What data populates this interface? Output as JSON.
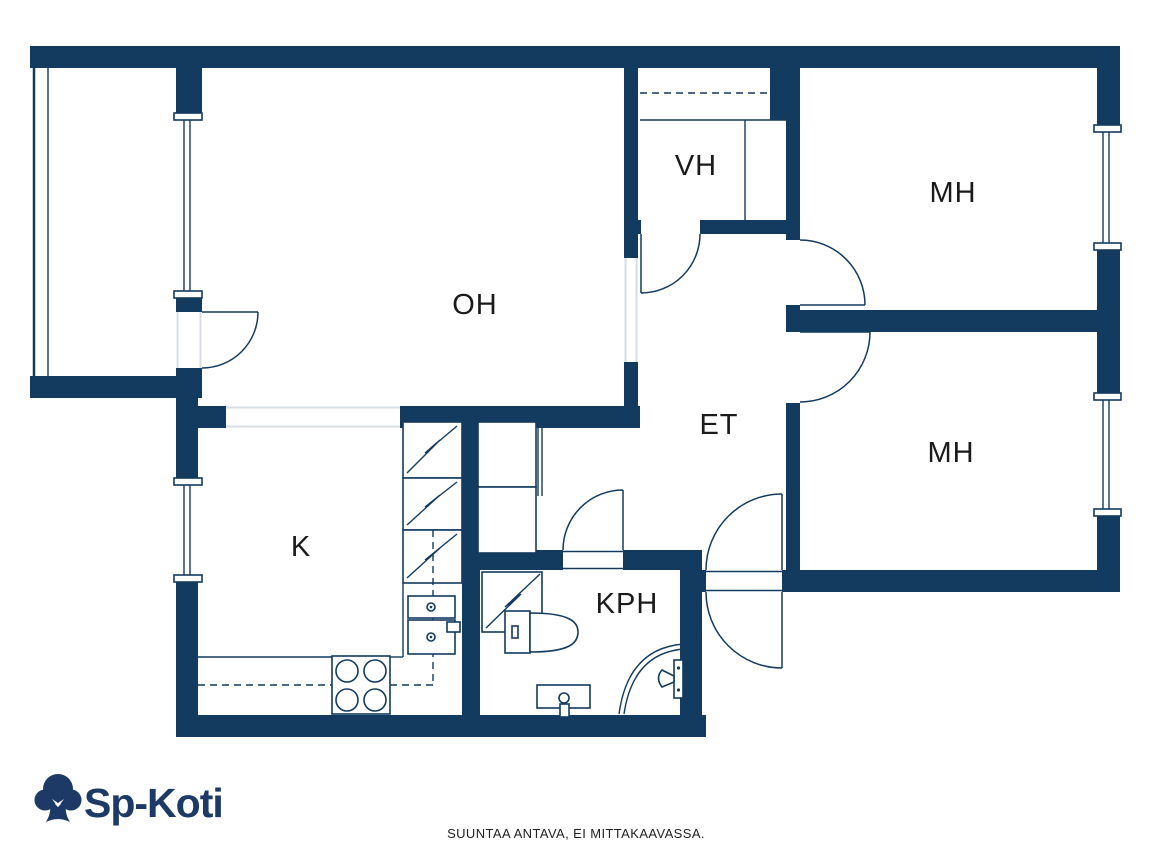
{
  "plan": {
    "rooms": [
      {
        "id": "oh",
        "label": "OH"
      },
      {
        "id": "vh",
        "label": "VH"
      },
      {
        "id": "mh-top",
        "label": "MH"
      },
      {
        "id": "mh-mid",
        "label": "MH"
      },
      {
        "id": "et",
        "label": "ET"
      },
      {
        "id": "k",
        "label": "K"
      },
      {
        "id": "kph",
        "label": "KPH"
      }
    ]
  },
  "footer": {
    "disclaimer": "SUUNTAA ANTAVA, EI MITTAKAAVASSA."
  },
  "logo": {
    "text": "Sp-Koti",
    "icon": "tree-icon"
  },
  "colors": {
    "wall": "#133A5F",
    "label": "#1A1A1A",
    "logo": "#1D3A66",
    "opening": "#D7DDE3",
    "background": "#FFFFFF"
  }
}
